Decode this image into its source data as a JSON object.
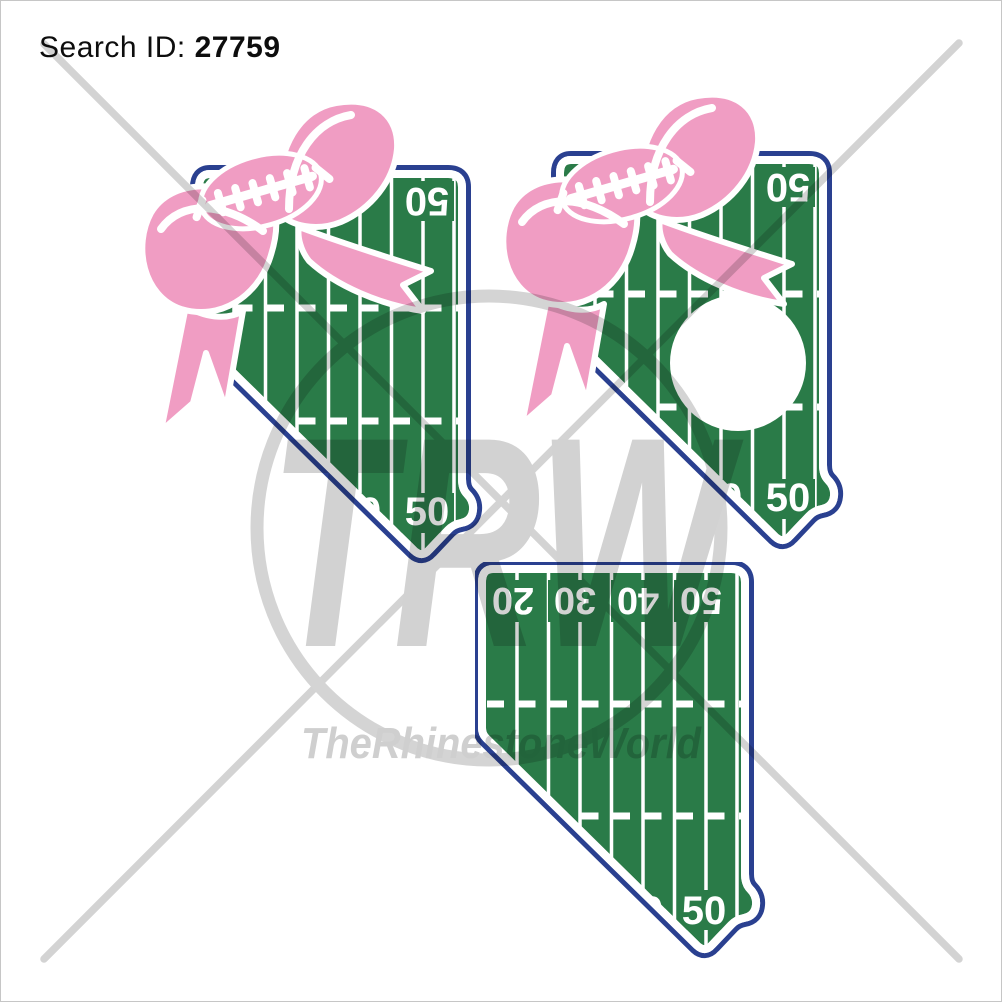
{
  "header": {
    "search_id_label": "Search ID:",
    "search_id_value": "27759"
  },
  "watermark": {
    "initials": "TRW",
    "brand": "TheRhinestoneWorld"
  },
  "colors": {
    "field_green": "#2A7B48",
    "outline_navy": "#2A4090",
    "bow_pink": "#F09DC3",
    "line_white": "#FFFFFF",
    "watermark_gray": "#D3D3D3"
  },
  "designs": {
    "bow_field": {
      "label": "nevada-football-field-with-bow",
      "top_number": "50",
      "bottom_number": "50",
      "clipped_number": "40"
    },
    "bow_monogram_field": {
      "label": "nevada-football-field-with-bow-and-monogram",
      "top_number": "50",
      "bottom_number": "50",
      "clipped_number": "40"
    },
    "plain_field": {
      "label": "nevada-football-field",
      "top_numbers": [
        "20",
        "30",
        "40",
        "50"
      ],
      "bottom_number": "50",
      "clipped_number": "40"
    }
  }
}
